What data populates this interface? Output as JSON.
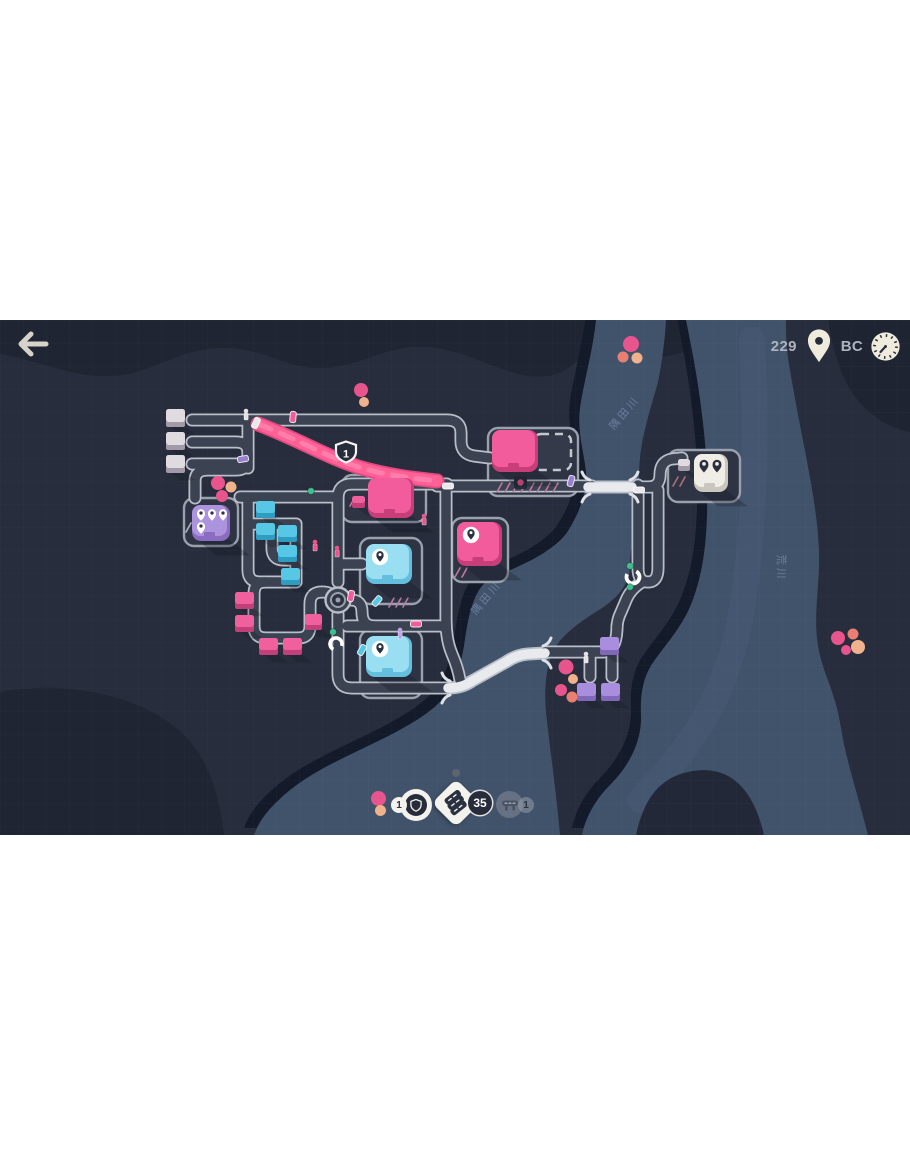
{
  "hud": {
    "back_icon": "arrow-left",
    "pins_collected": "229",
    "city_code": "BC",
    "traffic_upgrade_count": "1",
    "road_tile_count": "35",
    "motorway_count": "1"
  },
  "map": {
    "motorway_marker": "1",
    "river_labels": [
      "隅田川",
      "隅田川",
      "荒川"
    ],
    "houses": [
      {
        "x": 166,
        "y": 89,
        "w": 19,
        "h": 18,
        "c": "white"
      },
      {
        "x": 166,
        "y": 112,
        "w": 19,
        "h": 18,
        "c": "white"
      },
      {
        "x": 166,
        "y": 135,
        "w": 19,
        "h": 18,
        "c": "white"
      },
      {
        "x": 256,
        "y": 181,
        "w": 19,
        "h": 17,
        "c": "cyan"
      },
      {
        "x": 256,
        "y": 203,
        "w": 19,
        "h": 17,
        "c": "cyan"
      },
      {
        "x": 278,
        "y": 205,
        "w": 19,
        "h": 17,
        "c": "cyan"
      },
      {
        "x": 278,
        "y": 225,
        "w": 19,
        "h": 17,
        "c": "cyan"
      },
      {
        "x": 281,
        "y": 248,
        "w": 19,
        "h": 17,
        "c": "cyan"
      },
      {
        "x": 235,
        "y": 272,
        "w": 19,
        "h": 17,
        "c": "pink"
      },
      {
        "x": 235,
        "y": 295,
        "w": 19,
        "h": 17,
        "c": "pink"
      },
      {
        "x": 259,
        "y": 318,
        "w": 19,
        "h": 17,
        "c": "pink"
      },
      {
        "x": 283,
        "y": 318,
        "w": 19,
        "h": 17,
        "c": "pink"
      },
      {
        "x": 305,
        "y": 294,
        "w": 17,
        "h": 16,
        "c": "pink"
      },
      {
        "x": 600,
        "y": 317,
        "w": 19,
        "h": 18,
        "c": "purple"
      },
      {
        "x": 577,
        "y": 363,
        "w": 19,
        "h": 18,
        "c": "purple"
      },
      {
        "x": 601,
        "y": 363,
        "w": 19,
        "h": 18,
        "c": "purple"
      },
      {
        "x": 352,
        "y": 176,
        "w": 13,
        "h": 12,
        "c": "pink"
      },
      {
        "x": 678,
        "y": 139,
        "w": 12,
        "h": 12,
        "c": "white"
      }
    ],
    "lots": [
      {
        "x": 184,
        "y": 178,
        "w": 54,
        "h": 48
      },
      {
        "x": 488,
        "y": 108,
        "w": 90,
        "h": 68
      },
      {
        "x": 342,
        "y": 155,
        "w": 84,
        "h": 47
      },
      {
        "x": 452,
        "y": 198,
        "w": 56,
        "h": 64
      },
      {
        "x": 360,
        "y": 218,
        "w": 62,
        "h": 66
      },
      {
        "x": 360,
        "y": 310,
        "w": 62,
        "h": 68
      },
      {
        "x": 668,
        "y": 130,
        "w": 72,
        "h": 52
      }
    ],
    "destinations": [
      {
        "x": 192,
        "y": 185,
        "w": 38,
        "h": 36,
        "c": "purple",
        "pins": "white4"
      },
      {
        "x": 492,
        "y": 110,
        "w": 46,
        "h": 42,
        "c": "pink",
        "pins": "none"
      },
      {
        "x": 368,
        "y": 158,
        "w": 46,
        "h": 40,
        "c": "pink",
        "pins": "none"
      },
      {
        "x": 457,
        "y": 202,
        "w": 45,
        "h": 44,
        "c": "pink",
        "pins": "badge"
      },
      {
        "x": 366,
        "y": 224,
        "w": 46,
        "h": 40,
        "c": "cyan",
        "pins": "badge"
      },
      {
        "x": 366,
        "y": 316,
        "w": 46,
        "h": 41,
        "c": "cyan",
        "pins": "badge"
      },
      {
        "x": 694,
        "y": 134,
        "w": 34,
        "h": 38,
        "c": "whitebld",
        "pins": "dark2"
      }
    ],
    "dots": [
      [
        361,
        70,
        7,
        "pink"
      ],
      [
        364,
        82,
        5,
        "peach"
      ],
      [
        631,
        24,
        8,
        "pink"
      ],
      [
        623,
        37,
        5.5,
        "salmon"
      ],
      [
        637,
        38,
        5.5,
        "peach"
      ],
      [
        218,
        163,
        7,
        "pink"
      ],
      [
        231,
        167,
        5.5,
        "peach"
      ],
      [
        222,
        176,
        6,
        "pink"
      ],
      [
        566,
        347,
        7.5,
        "pink"
      ],
      [
        573,
        359,
        5,
        "peach"
      ],
      [
        561,
        370,
        6,
        "pink"
      ],
      [
        572,
        377,
        5.5,
        "salmon"
      ],
      [
        838,
        318,
        7,
        "pink"
      ],
      [
        846,
        330,
        5,
        "pink"
      ],
      [
        853,
        314,
        5.5,
        "salmon"
      ],
      [
        858,
        327,
        7,
        "peach"
      ],
      [
        456,
        453,
        4,
        "gray"
      ]
    ],
    "cars": [
      [
        256,
        103,
        25,
        "white"
      ],
      [
        293,
        97,
        5,
        "pink"
      ],
      [
        243,
        139,
        80,
        "purple"
      ],
      [
        448,
        166,
        90,
        "white"
      ],
      [
        571,
        161,
        15,
        "purple"
      ],
      [
        639,
        170,
        90,
        "white"
      ],
      [
        351,
        276,
        10,
        "pink"
      ],
      [
        416,
        304,
        90,
        "pink"
      ],
      [
        362,
        330,
        30,
        "cyan"
      ],
      [
        377,
        281,
        40,
        "cyan"
      ]
    ],
    "trees": [
      [
        311,
        171
      ],
      [
        333,
        312
      ],
      [
        630,
        246
      ],
      [
        630,
        267
      ]
    ],
    "people": [
      [
        315,
        226,
        "pink"
      ],
      [
        424,
        200,
        "pink"
      ],
      [
        337,
        232,
        "pink"
      ],
      [
        400,
        314,
        "purple"
      ],
      [
        586,
        338,
        "white"
      ],
      [
        246,
        95,
        "white"
      ]
    ],
    "hatches": [
      {
        "x": 497,
        "y": 172,
        "n": 8,
        "step": 8,
        "color": "#bf7ba0"
      },
      {
        "x": 350,
        "y": 186,
        "n": 2,
        "step": 8,
        "color": "#bf7ba0"
      },
      {
        "x": 455,
        "y": 257,
        "n": 2,
        "step": 7,
        "color": "#bf7ba0"
      },
      {
        "x": 389,
        "y": 287,
        "n": 3,
        "step": 7,
        "color": "#bf7ba0"
      },
      {
        "x": 673,
        "y": 166,
        "n": 2,
        "step": 7,
        "color": "#b06f77"
      },
      {
        "x": 186,
        "y": 212,
        "n": 2,
        "step": 7,
        "color": "#aeb4be"
      }
    ]
  },
  "colors": {
    "bg": "#272d3c",
    "bg_dark": "#1f2533",
    "water": "#41536b",
    "water_shadow": "#131a29",
    "road": "#3b4251",
    "road_outline": "#b9bfc9",
    "bridge": "#e9eaee",
    "motorway": "#ff6096",
    "motorway_dark": "#e04a80",
    "motorway_light": "#ff8ab2",
    "house_white_top": "#dfdbe0",
    "house_white_front": "#a39aa8",
    "house_cyan_top": "#56c8e6",
    "house_cyan_front": "#2f9dc2",
    "house_pink_top": "#f0609c",
    "house_pink_front": "#c2407a",
    "house_purple_top": "#a98ede",
    "house_purple_front": "#8168b8",
    "bld_pink": "#f25c9c",
    "bld_pink_dark": "#c73e78",
    "bld_cyan": "#9adef2",
    "bld_cyan_dark": "#64bedd",
    "bld_purple": "#ab93de",
    "bld_purple_dark": "#8a6cc0",
    "bld_white": "#f0ede6",
    "bld_white_dark": "#c9c6bd",
    "pin_pink": "#e8558d",
    "pin_peach": "#f0b28c",
    "pin_salmon": "#e87f70",
    "dark_navy": "#262c3a",
    "hud_cream": "#efecdd",
    "hud_text": "#aeb4bf",
    "tree": "#41c08f",
    "gray_dot": "#5d6470"
  }
}
